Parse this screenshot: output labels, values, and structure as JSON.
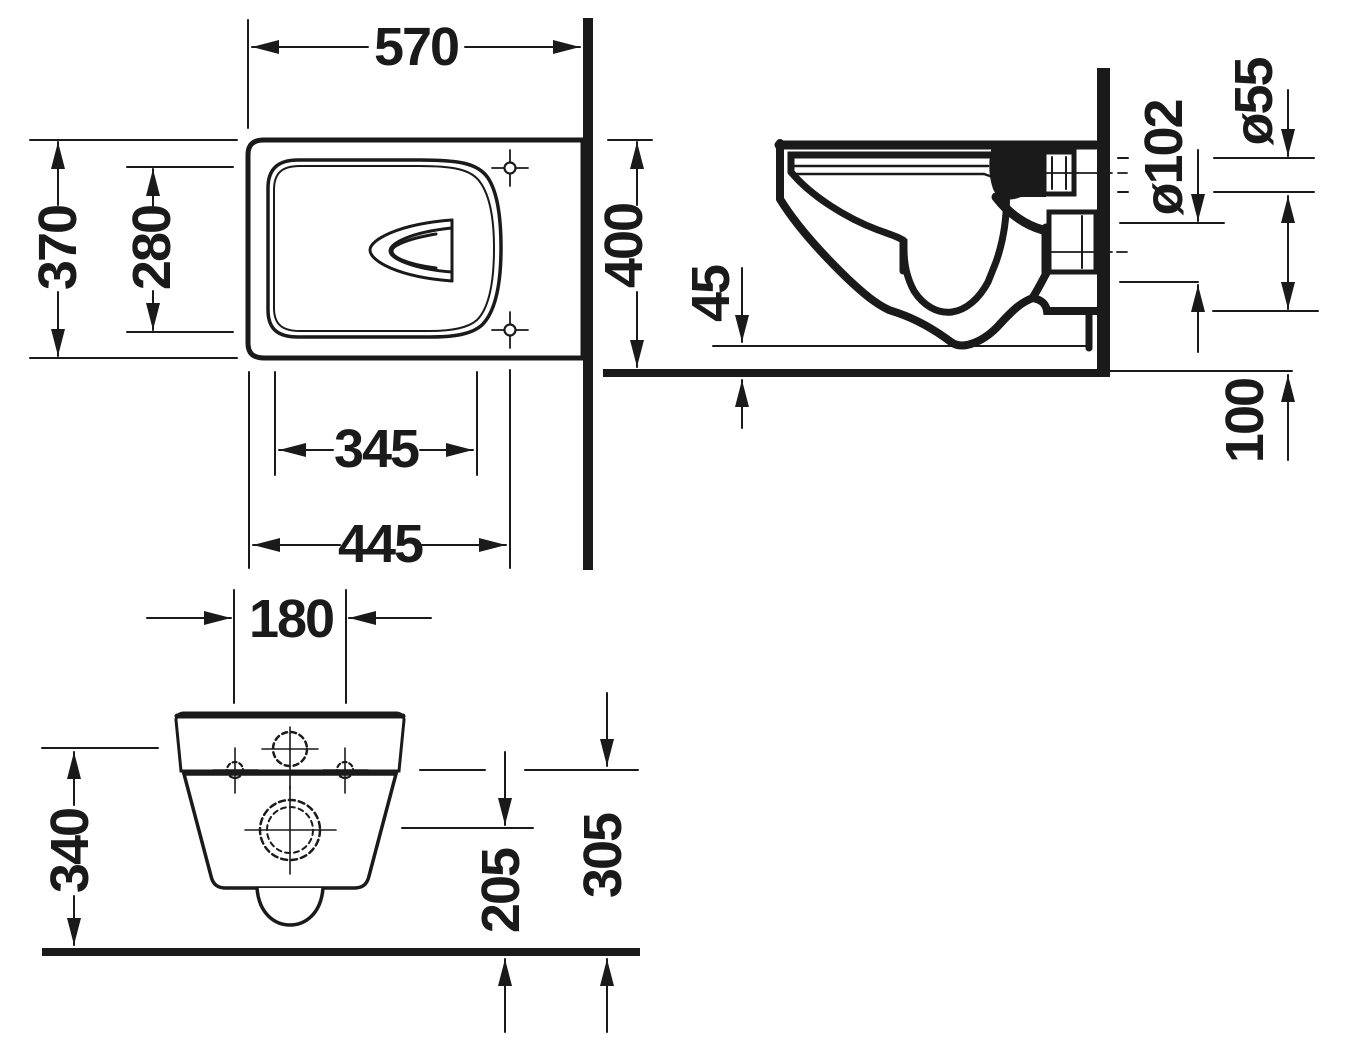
{
  "drawing": {
    "type": "technical-dimension-drawing",
    "subject": "wall-hung-toilet",
    "colors": {
      "line": "#1a1a1a",
      "background": "#ffffff"
    },
    "views": {
      "plan": {
        "dims": {
          "overall_depth": "570",
          "overall_width": "370",
          "seat_inner_width": "280",
          "inner_length": "345",
          "fixing_length": "445"
        }
      },
      "side": {
        "dims": {
          "overall_height": "400",
          "front_clearance": "45",
          "drain_diameter": "ø102",
          "supply_diameter": "ø55",
          "bottom_offset": "100"
        }
      },
      "rear": {
        "dims": {
          "fixing_hole_spacing": "180",
          "supply_height": "340",
          "drain_height": "205",
          "fixing_height": "305"
        }
      }
    }
  }
}
